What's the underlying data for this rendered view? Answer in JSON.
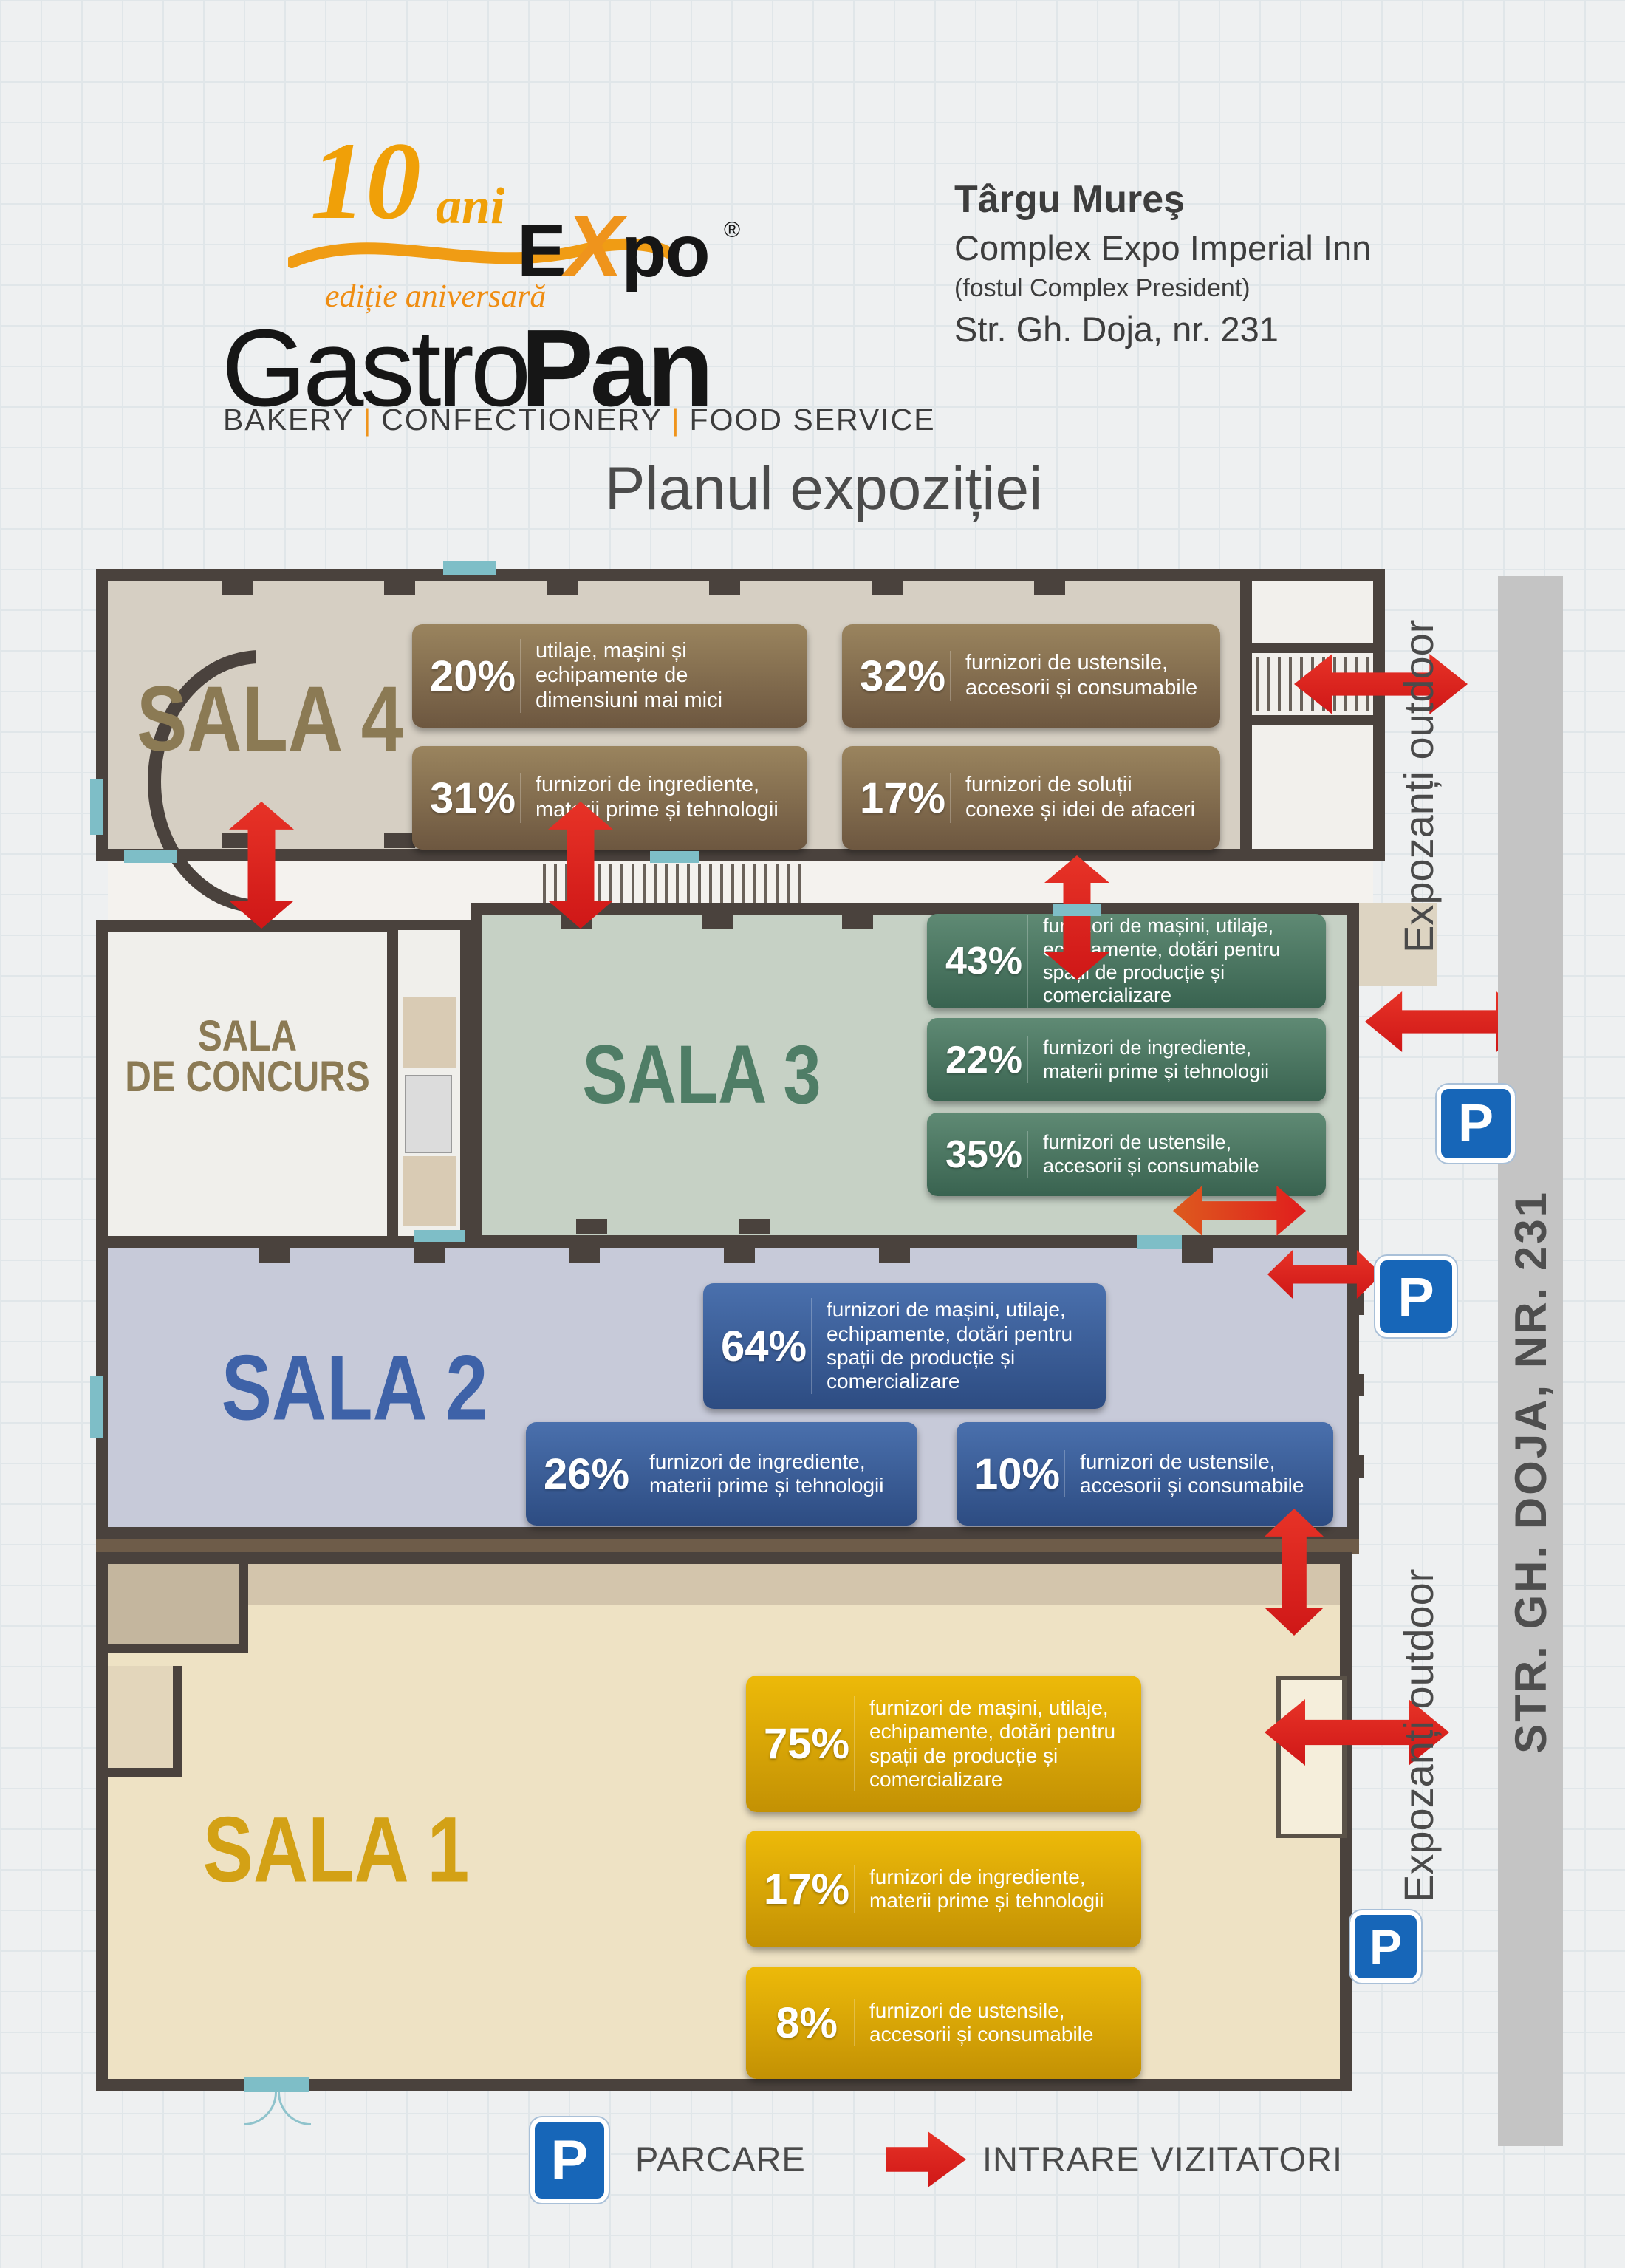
{
  "header": {
    "logo": {
      "anniversary_number": "10",
      "anniversary_word": "ani",
      "edition": "ediție aniversară",
      "brand_left": "Gastro",
      "brand_e": "E",
      "brand_x": "X",
      "brand_po": "po",
      "brand_right": "Pan",
      "registered": "®",
      "tagline": [
        "BAKERY",
        "CONFECTIONERY",
        "FOOD SERVICE"
      ]
    },
    "venue": {
      "city": "Târgu Mureş",
      "complex": "Complex Expo Imperial Inn",
      "former_name": "(fostul Complex President)",
      "address": "Str. Gh. Doja, nr. 231"
    }
  },
  "title": "Planul expoziției",
  "map": {
    "street_label": "STR. GH. DOJA, NR. 231",
    "outdoor_label_top": "Expozanți outdoor",
    "outdoor_label_bottom": "Expozanți outdoor",
    "parking_symbol": "P",
    "rooms": {
      "sala4": {
        "name": "SALA 4",
        "stats": [
          {
            "pct": "20%",
            "text": "utilaje, mașini și echipamente de dimensiuni mai mici"
          },
          {
            "pct": "32%",
            "text": "furnizori de ustensile, accesorii și consumabile"
          },
          {
            "pct": "31%",
            "text": "furnizori de ingrediente, materii prime și tehnologii"
          },
          {
            "pct": "17%",
            "text": "furnizori de soluții conexe și idei de afaceri"
          }
        ]
      },
      "sala_concurs": {
        "name_line1": "SALA",
        "name_line2": "DE CONCURS"
      },
      "sala3": {
        "name": "SALA 3",
        "stats": [
          {
            "pct": "43%",
            "text": "furnizori de mașini, utilaje, echipamente, dotări pentru spații de producție și comercializare"
          },
          {
            "pct": "22%",
            "text": "furnizori de ingrediente, materii prime și tehnologii"
          },
          {
            "pct": "35%",
            "text": "furnizori de ustensile, accesorii și consumabile"
          }
        ]
      },
      "sala2": {
        "name": "SALA 2",
        "stats": [
          {
            "pct": "64%",
            "text": "furnizori de mașini, utilaje, echipamente, dotări pentru spații de producție și comercializare"
          },
          {
            "pct": "26%",
            "text": "furnizori de ingrediente, materii prime și tehnologii"
          },
          {
            "pct": "10%",
            "text": "furnizori de ustensile, accesorii și consumabile"
          }
        ]
      },
      "sala1": {
        "name": "SALA 1",
        "stats": [
          {
            "pct": "75%",
            "text": "furnizori de mașini, utilaje, echipamente, dotări pentru spații de producție și comercializare"
          },
          {
            "pct": "17%",
            "text": "furnizori de ingrediente, materii prime și tehnologii"
          },
          {
            "pct": "8%",
            "text": "furnizori de ustensile, accesorii și consumabile"
          }
        ]
      }
    }
  },
  "legend": {
    "parking": "PARCARE",
    "entrance": "INTRARE VIZITATORI"
  },
  "colors": {
    "red_arrow": "#e11f1f",
    "sala4_brown": "#8b7a54",
    "sala3_green": "#4f7d66",
    "sala2_blue": "#3e62a8",
    "sala1_yellow": "#d3a115",
    "wall": "#4a423d",
    "parking_blue": "#1766b8",
    "accent_orange": "#ef941c"
  }
}
